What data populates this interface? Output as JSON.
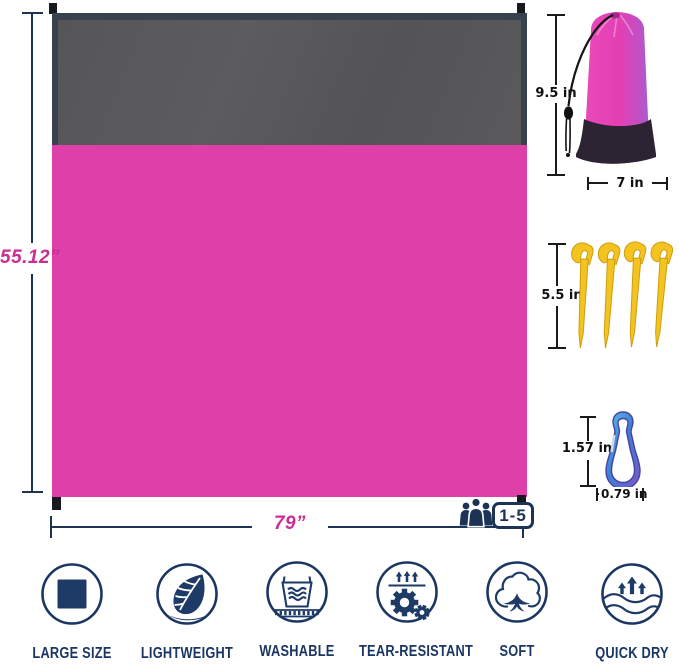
{
  "blanket": {
    "height_label": "55.12”",
    "width_label": "79”",
    "capacity_label": "1-5",
    "capacity_icon": "people-icon",
    "colors": {
      "top_band": "#59585a",
      "body": "#de3fa8",
      "trim": "#38424f",
      "dimension": "#1d3356",
      "label_pink": "#cb2e91"
    }
  },
  "bag": {
    "height_label": "9.5 in",
    "width_label": "7 in",
    "colors": {
      "body": "#e33fb4",
      "bottom": "#2c2433"
    }
  },
  "stakes": {
    "length_label": "5.5 in",
    "count": 4,
    "color": "#f3c41f"
  },
  "carabiner": {
    "height_label": "1.57 in",
    "width_label": "0.79 in",
    "colors": {
      "start": "#5fc3ea",
      "mid": "#3f7fd6",
      "end": "#7a55c8"
    }
  },
  "features": {
    "accent_color": "#1c3663",
    "items": [
      {
        "label": "LARGE SIZE",
        "icon": "square-icon"
      },
      {
        "label": "LIGHTWEIGHT",
        "icon": "leaf-icon"
      },
      {
        "label": "WASHABLE",
        "icon": "wash-basin-icon"
      },
      {
        "label": "TEAR-RESISTANT",
        "icon": "gears-icon"
      },
      {
        "label": "SOFT",
        "icon": "cotton-icon"
      },
      {
        "label": "QUICK DRY",
        "icon": "waves-arrows-icon"
      }
    ]
  }
}
